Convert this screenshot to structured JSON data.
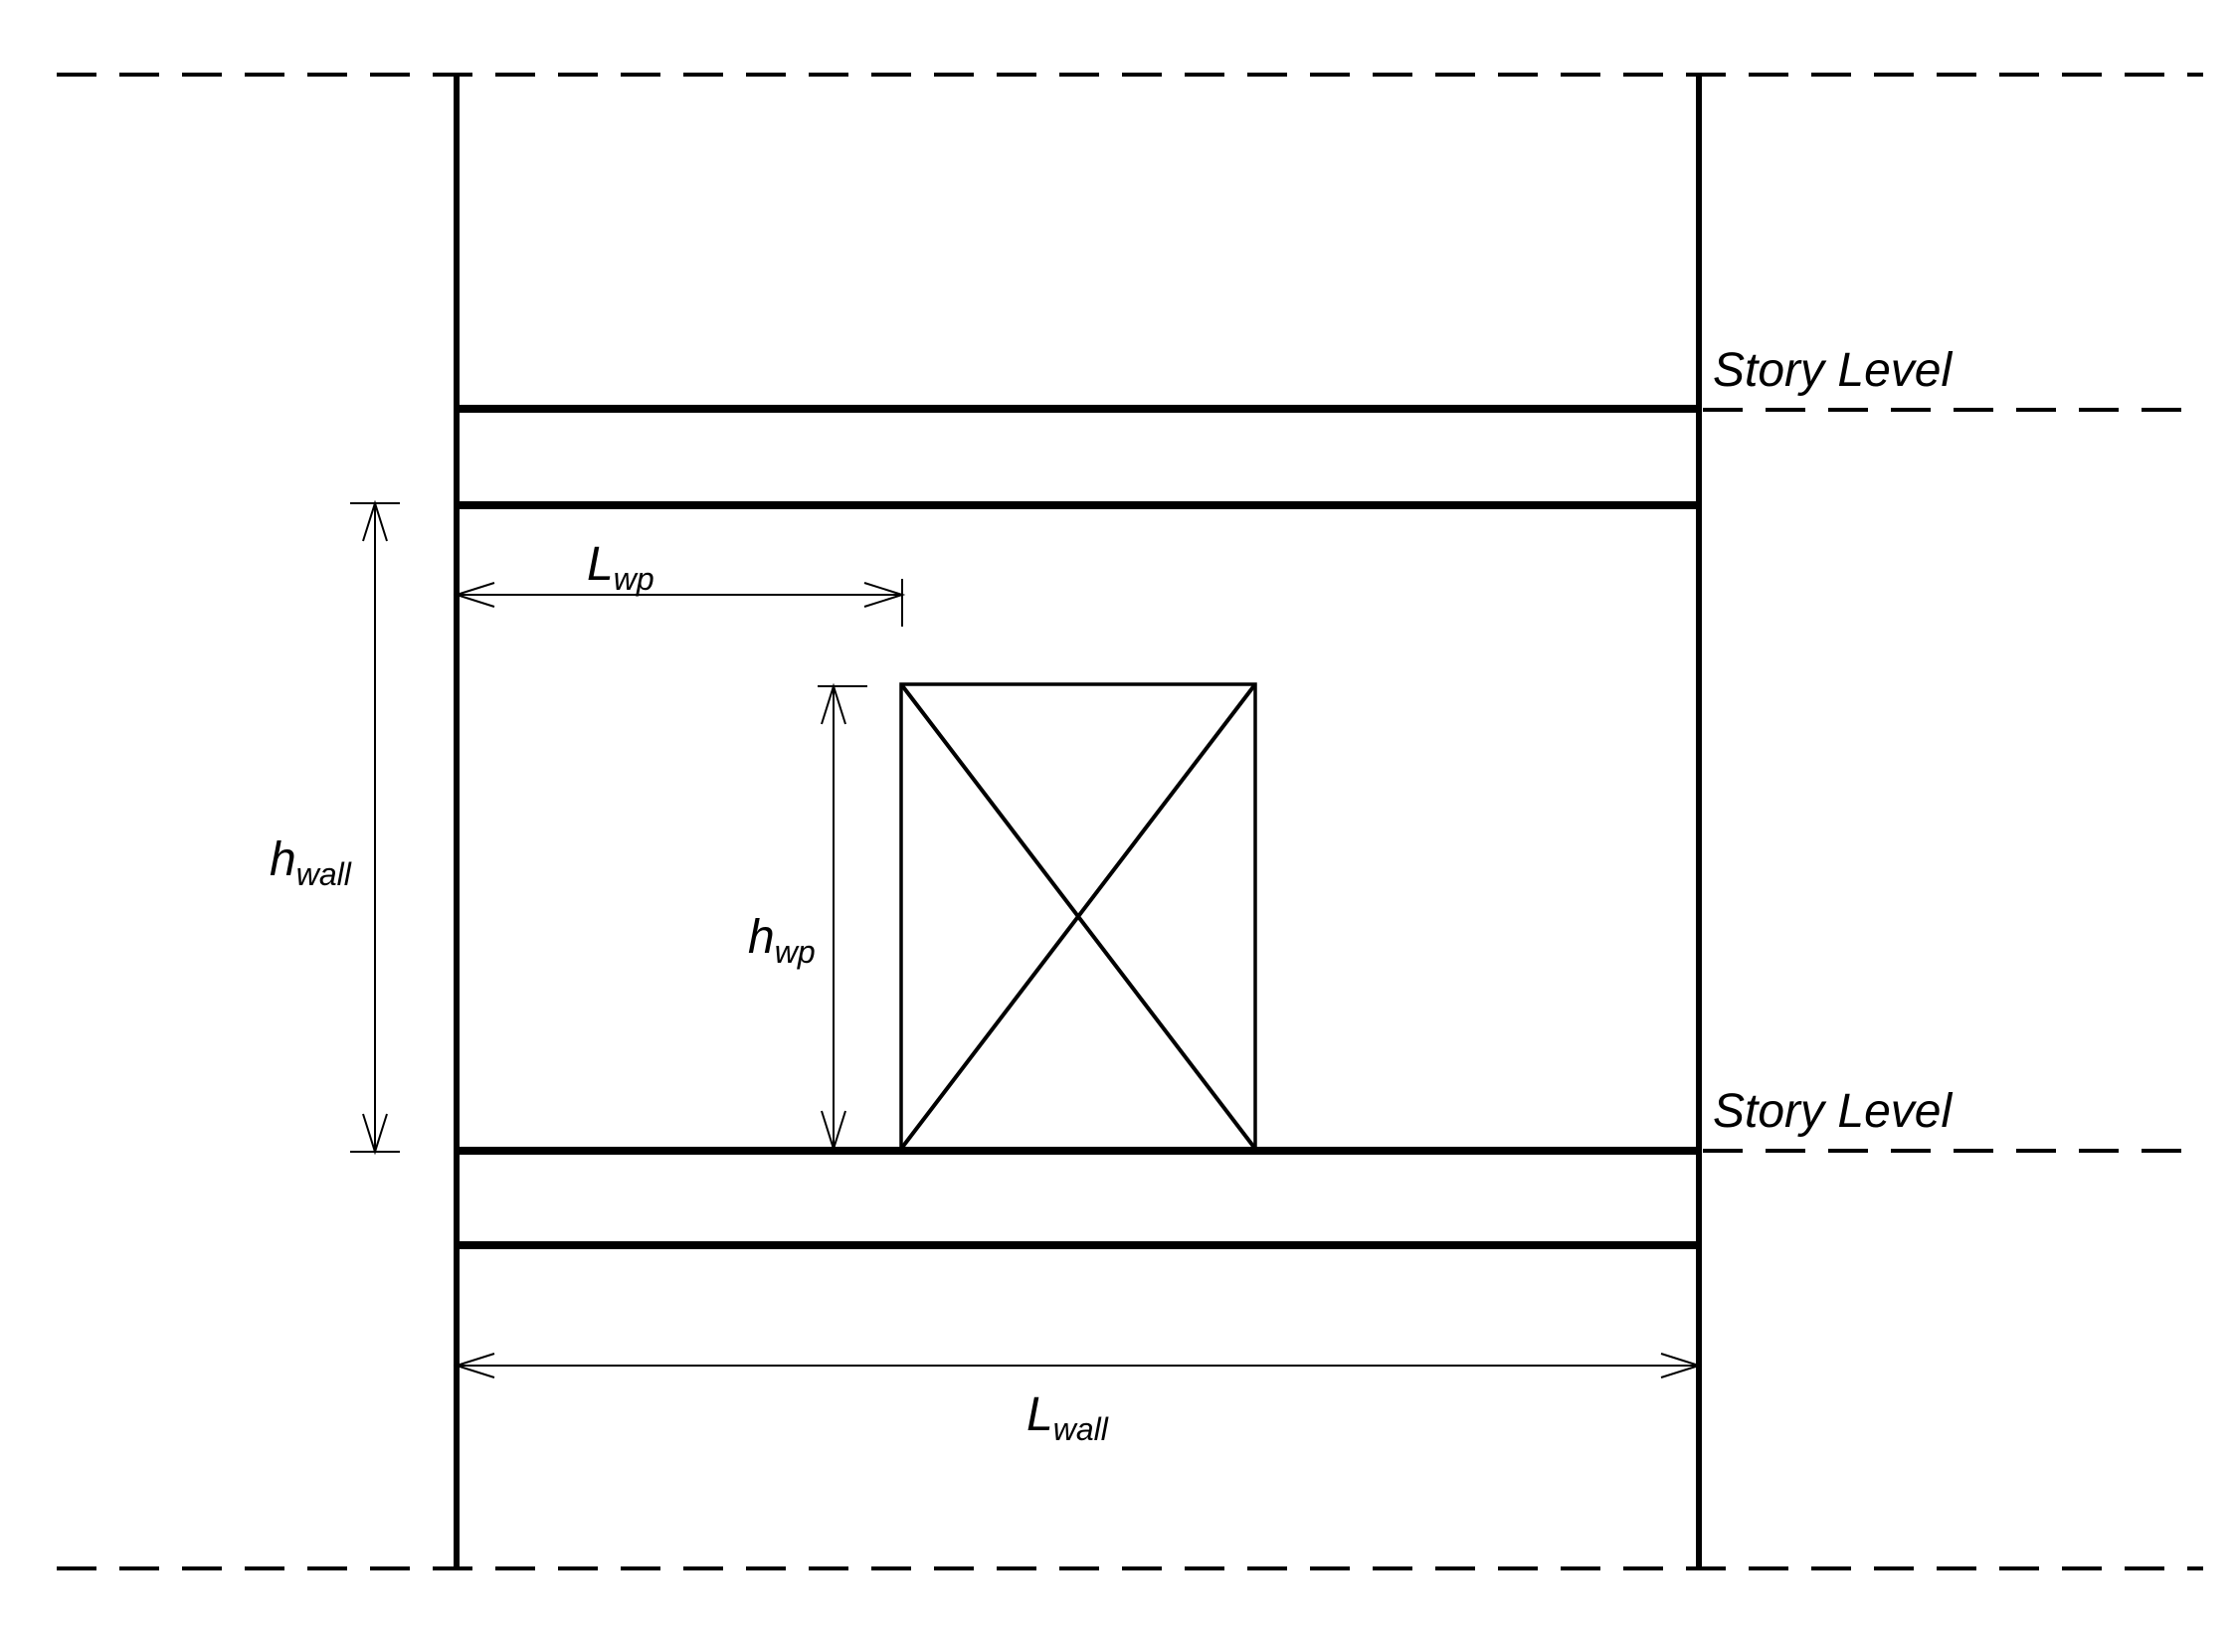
{
  "diagram": {
    "background_color": "#ffffff",
    "line_color": "#000000",
    "labels": {
      "story_level_top": "Story Level",
      "story_level_bottom": "Story Level"
    },
    "dimensions": {
      "lwp": {
        "symbol": "L",
        "subscript": "wp"
      },
      "hwp": {
        "symbol": "h",
        "subscript": "wp"
      },
      "hwall": {
        "symbol": "h",
        "subscript": "wall"
      },
      "lwall": {
        "symbol": "L",
        "subscript": "wall"
      }
    }
  }
}
